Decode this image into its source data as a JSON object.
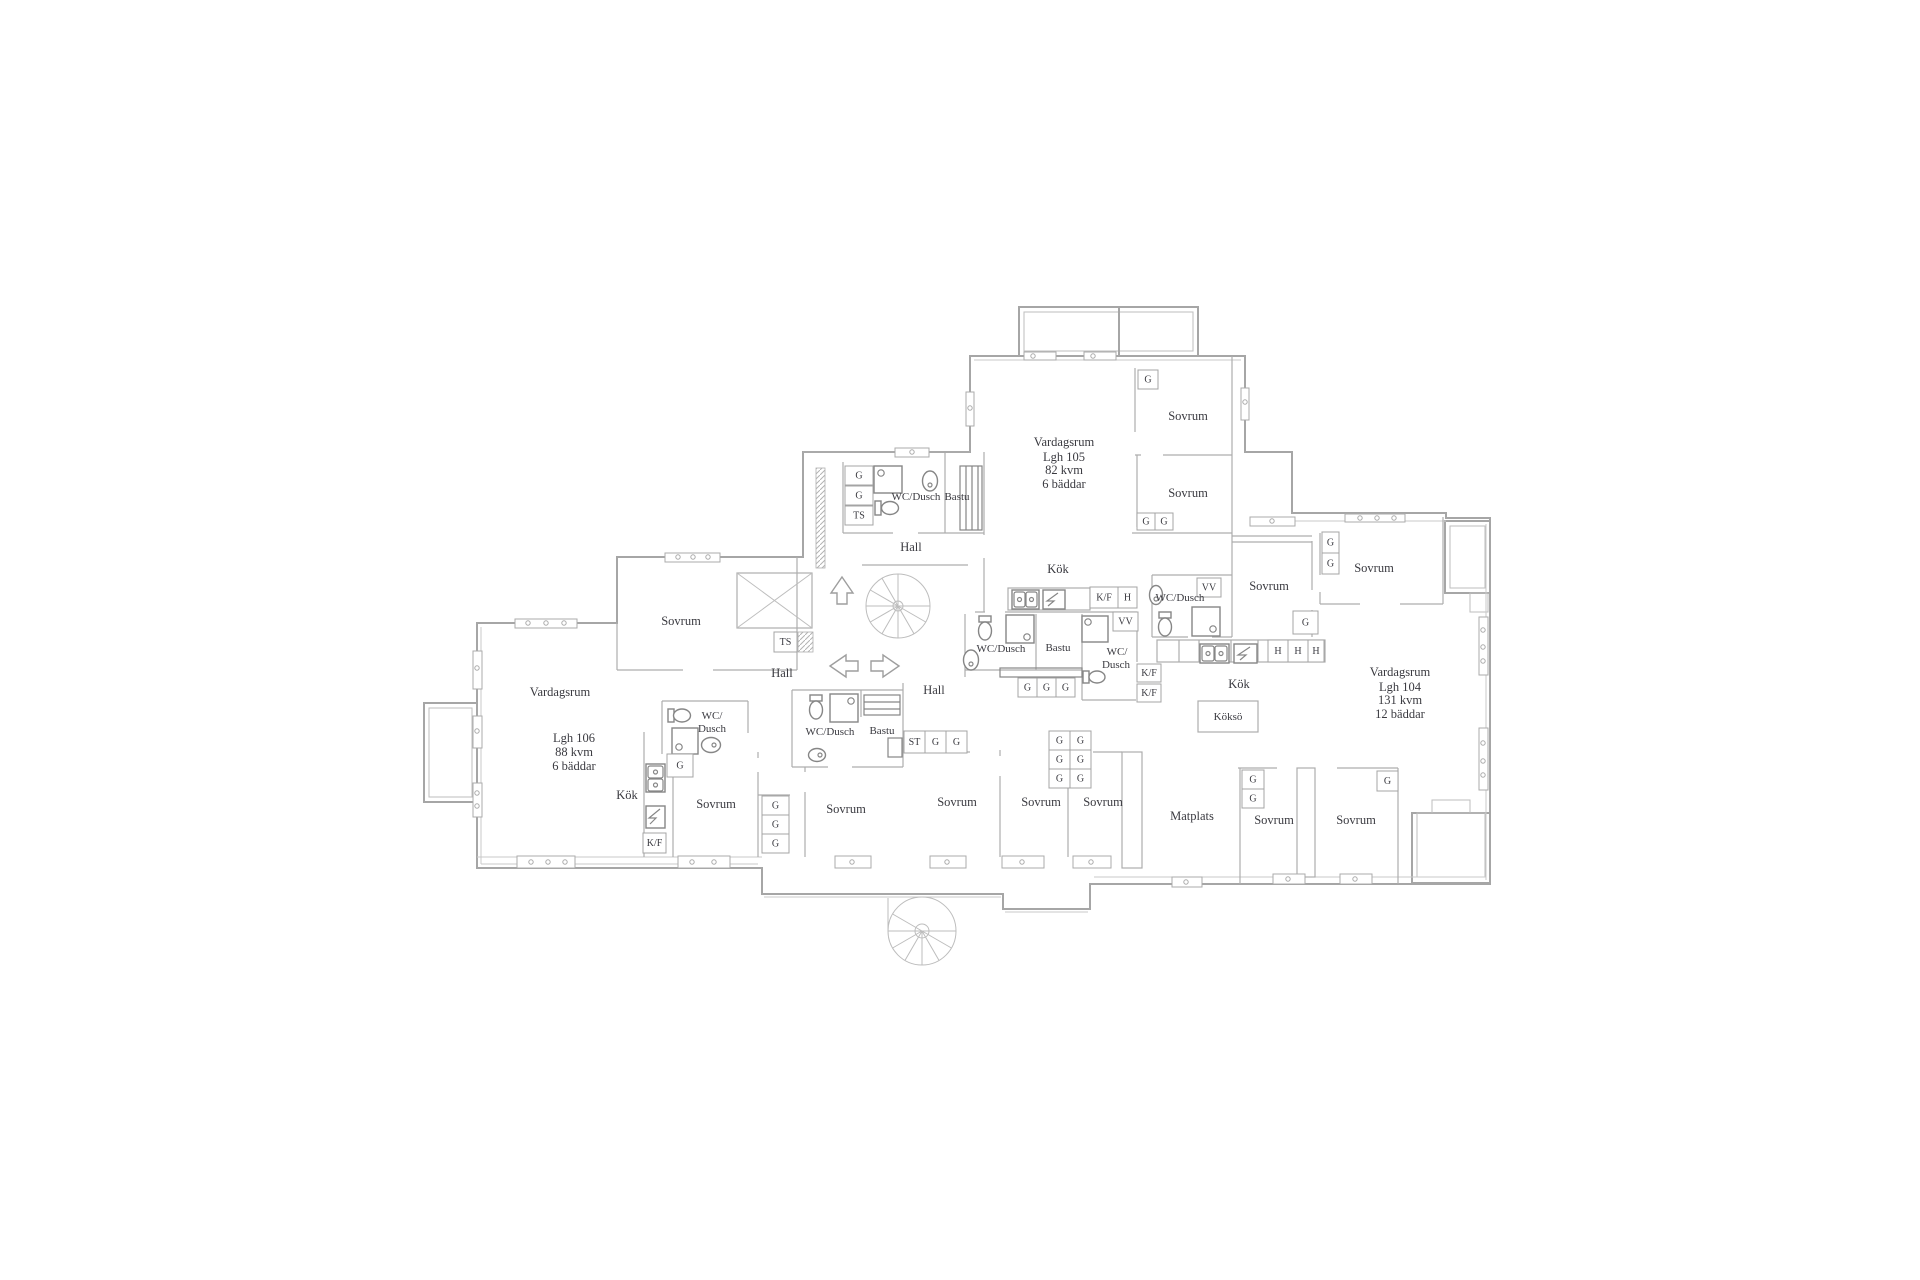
{
  "colors": {
    "background": "#ffffff",
    "wall": "#a6a6a6",
    "fixture": "#868686",
    "text": "#3a3a40"
  },
  "apartments": [
    {
      "name": "Lgh 104",
      "living_room": "Vardagsrum",
      "area": "131 kvm",
      "beds": "12 bäddar"
    },
    {
      "name": "Lgh 105",
      "living_room": "Vardagsrum",
      "area": "82 kvm",
      "beds": "6 bäddar"
    },
    {
      "name": "Lgh 106",
      "living_room": "Vardagsrum",
      "area": "88 kvm",
      "beds": "6 bäddar"
    }
  ],
  "room_labels": [
    {
      "t": "Vardagsrum",
      "x": 1064,
      "y": 442
    },
    {
      "t": "Lgh 105",
      "x": 1064,
      "y": 457
    },
    {
      "t": "82 kvm",
      "x": 1064,
      "y": 470
    },
    {
      "t": "6 bäddar",
      "x": 1064,
      "y": 484
    },
    {
      "t": "Sovrum",
      "x": 1188,
      "y": 416
    },
    {
      "t": "Sovrum",
      "x": 1188,
      "y": 493
    },
    {
      "t": "Kök",
      "x": 1058,
      "y": 569
    },
    {
      "t": "WC/Dusch",
      "x": 916,
      "y": 497,
      "s": 11
    },
    {
      "t": "Bastu",
      "x": 957,
      "y": 497,
      "s": 11
    },
    {
      "t": "Hall",
      "x": 911,
      "y": 547
    },
    {
      "t": "Sovrum",
      "x": 681,
      "y": 621
    },
    {
      "t": "Hall",
      "x": 782,
      "y": 673
    },
    {
      "t": "Hall",
      "x": 934,
      "y": 690
    },
    {
      "t": "Vardagsrum",
      "x": 560,
      "y": 692
    },
    {
      "t": "Lgh 106",
      "x": 574,
      "y": 738
    },
    {
      "t": "88 kvm",
      "x": 574,
      "y": 752
    },
    {
      "t": "6 bäddar",
      "x": 574,
      "y": 766
    },
    {
      "t": "WC/",
      "x": 712,
      "y": 716,
      "s": 11
    },
    {
      "t": "Dusch",
      "x": 712,
      "y": 729,
      "s": 11
    },
    {
      "t": "Kök",
      "x": 627,
      "y": 795
    },
    {
      "t": "Sovrum",
      "x": 716,
      "y": 804
    },
    {
      "t": "Sovrum",
      "x": 846,
      "y": 809
    },
    {
      "t": "WC/Dusch",
      "x": 830,
      "y": 732,
      "s": 11
    },
    {
      "t": "Bastu",
      "x": 882,
      "y": 731,
      "s": 11
    },
    {
      "t": "Sovrum",
      "x": 957,
      "y": 802
    },
    {
      "t": "Sovrum",
      "x": 1041,
      "y": 802
    },
    {
      "t": "Sovrum",
      "x": 1103,
      "y": 802
    },
    {
      "t": "Matplats",
      "x": 1192,
      "y": 816
    },
    {
      "t": "WC/Dusch",
      "x": 1001,
      "y": 649,
      "s": 11
    },
    {
      "t": "Bastu",
      "x": 1058,
      "y": 648,
      "s": 11
    },
    {
      "t": "WC/",
      "x": 1117,
      "y": 652,
      "s": 11
    },
    {
      "t": "Dusch",
      "x": 1116,
      "y": 665,
      "s": 11
    },
    {
      "t": "WC/Dusch",
      "x": 1180,
      "y": 598,
      "s": 11
    },
    {
      "t": "Sovrum",
      "x": 1269,
      "y": 586
    },
    {
      "t": "Kök",
      "x": 1239,
      "y": 684
    },
    {
      "t": "Köksö",
      "x": 1228,
      "y": 717,
      "s": 11
    },
    {
      "t": "Vardagsrum",
      "x": 1400,
      "y": 672
    },
    {
      "t": "Lgh 104",
      "x": 1400,
      "y": 687
    },
    {
      "t": "131 kvm",
      "x": 1400,
      "y": 700
    },
    {
      "t": "12 bäddar",
      "x": 1400,
      "y": 714
    },
    {
      "t": "Sovrum",
      "x": 1374,
      "y": 568
    },
    {
      "t": "Sovrum",
      "x": 1274,
      "y": 820
    },
    {
      "t": "Sovrum",
      "x": 1356,
      "y": 820
    }
  ],
  "cabinet_labels": [
    {
      "t": "G",
      "x": 845,
      "y": 466,
      "w": 28,
      "h": 19
    },
    {
      "t": "G",
      "x": 845,
      "y": 486,
      "w": 28,
      "h": 19
    },
    {
      "t": "TS",
      "x": 845,
      "y": 506,
      "w": 28,
      "h": 19
    },
    {
      "t": "TS",
      "x": 774,
      "y": 632,
      "w": 23,
      "h": 20
    },
    {
      "t": "G",
      "x": 1138,
      "y": 370,
      "w": 20,
      "h": 19
    },
    {
      "t": "G",
      "x": 1137,
      "y": 513,
      "w": 18,
      "h": 17
    },
    {
      "t": "G",
      "x": 1155,
      "y": 513,
      "w": 18,
      "h": 17
    },
    {
      "t": "G",
      "x": 1322,
      "y": 532,
      "w": 17,
      "h": 21
    },
    {
      "t": "G",
      "x": 1322,
      "y": 553,
      "w": 17,
      "h": 21
    },
    {
      "t": "G",
      "x": 1293,
      "y": 611,
      "w": 25,
      "h": 23
    },
    {
      "t": "K/F",
      "x": 1090,
      "y": 587,
      "w": 28,
      "h": 21
    },
    {
      "t": "H",
      "x": 1118,
      "y": 587,
      "w": 19,
      "h": 21
    },
    {
      "t": "VV",
      "x": 1197,
      "y": 578,
      "w": 24,
      "h": 19
    },
    {
      "t": "VV",
      "x": 1113,
      "y": 612,
      "w": 25,
      "h": 19
    },
    {
      "t": "G",
      "x": 1018,
      "y": 678,
      "w": 19,
      "h": 19
    },
    {
      "t": "G",
      "x": 1037,
      "y": 678,
      "w": 19,
      "h": 19
    },
    {
      "t": "G",
      "x": 1056,
      "y": 678,
      "w": 19,
      "h": 19
    },
    {
      "t": "K/F",
      "x": 1137,
      "y": 664,
      "w": 24,
      "h": 18
    },
    {
      "t": "K/F",
      "x": 1137,
      "y": 684,
      "w": 24,
      "h": 18
    },
    {
      "t": "H",
      "x": 1268,
      "y": 640,
      "w": 20,
      "h": 22
    },
    {
      "t": "H",
      "x": 1288,
      "y": 640,
      "w": 20,
      "h": 22
    },
    {
      "t": "H",
      "x": 1308,
      "y": 640,
      "w": 16,
      "h": 22
    },
    {
      "t": "ST",
      "x": 904,
      "y": 731,
      "w": 21,
      "h": 22
    },
    {
      "t": "G",
      "x": 925,
      "y": 731,
      "w": 21,
      "h": 22
    },
    {
      "t": "G",
      "x": 946,
      "y": 731,
      "w": 21,
      "h": 22
    },
    {
      "t": "G",
      "x": 1049,
      "y": 731,
      "w": 21,
      "h": 19
    },
    {
      "t": "G",
      "x": 1070,
      "y": 731,
      "w": 21,
      "h": 19
    },
    {
      "t": "G",
      "x": 1049,
      "y": 750,
      "w": 21,
      "h": 19
    },
    {
      "t": "G",
      "x": 1070,
      "y": 750,
      "w": 21,
      "h": 19
    },
    {
      "t": "G",
      "x": 1049,
      "y": 769,
      "w": 21,
      "h": 19
    },
    {
      "t": "G",
      "x": 1070,
      "y": 769,
      "w": 21,
      "h": 19
    },
    {
      "t": "G",
      "x": 667,
      "y": 754,
      "w": 26,
      "h": 23
    },
    {
      "t": "K/F",
      "x": 643,
      "y": 833,
      "w": 23,
      "h": 20
    },
    {
      "t": "G",
      "x": 762,
      "y": 796,
      "w": 27,
      "h": 19
    },
    {
      "t": "G",
      "x": 762,
      "y": 815,
      "w": 27,
      "h": 19
    },
    {
      "t": "G",
      "x": 762,
      "y": 834,
      "w": 27,
      "h": 19
    },
    {
      "t": "G",
      "x": 1242,
      "y": 770,
      "w": 22,
      "h": 19
    },
    {
      "t": "G",
      "x": 1242,
      "y": 789,
      "w": 22,
      "h": 19
    },
    {
      "t": "G",
      "x": 1377,
      "y": 771,
      "w": 21,
      "h": 20
    }
  ]
}
